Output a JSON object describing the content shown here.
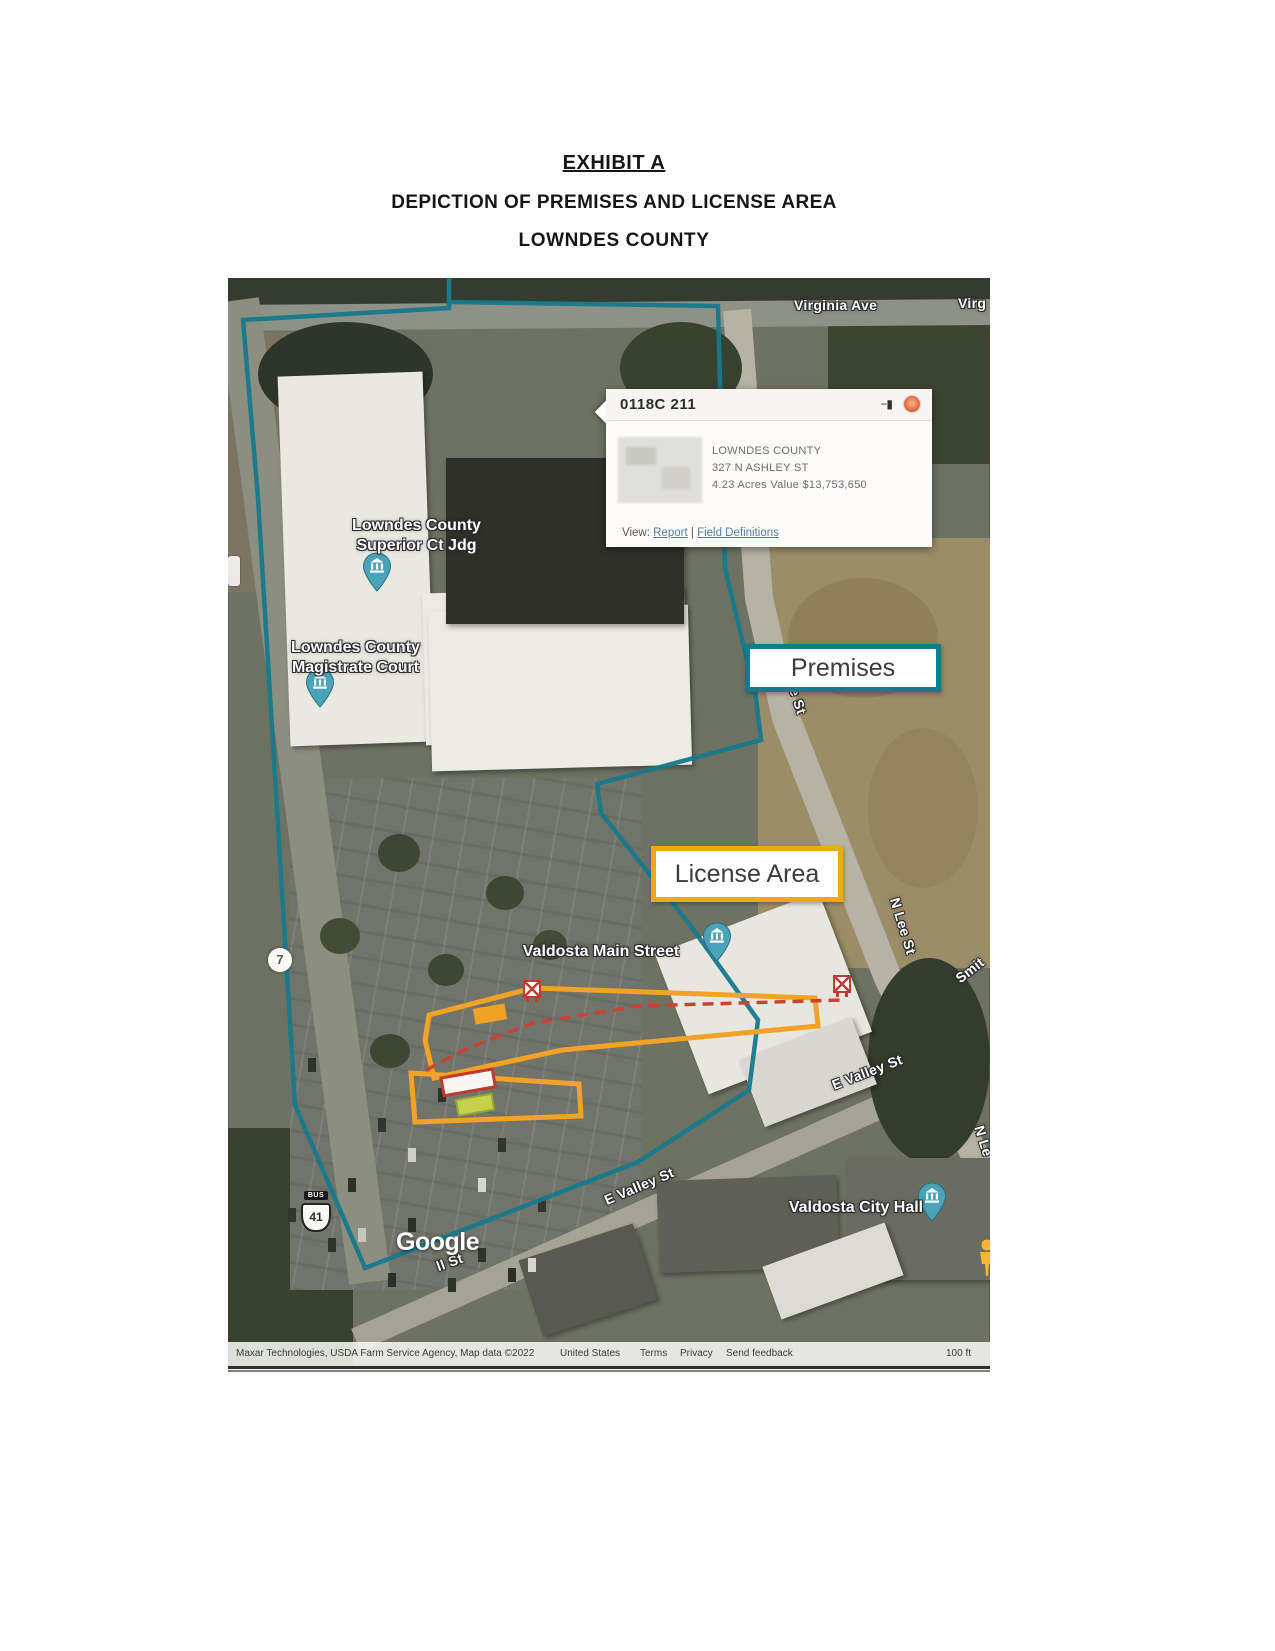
{
  "document": {
    "heading": "EXHIBIT A",
    "subheading": "DEPICTION OF PREMISES AND LICENSE AREA",
    "subheading2": "LOWNDES COUNTY"
  },
  "annotation_boxes": {
    "premises": "Premises",
    "license_area": "License Area"
  },
  "parcel_popup": {
    "parcel_id": "0118C 211",
    "owner": "LOWNDES COUNTY",
    "address": "327 N ASHLEY ST",
    "acres_value": "4.23 Acres  Value $13,753,650",
    "view_label": "View:",
    "report_link": "Report",
    "link_divider": "|",
    "field_definitions_link": "Field Definitions"
  },
  "map": {
    "poi": {
      "superior_court_line1": "Lowndes County",
      "superior_court_line2": "Superior Ct Jdg",
      "magistrate_line1": "Lowndes County",
      "magistrate_line2": "Magistrate Court",
      "valdosta_main_street": "Valdosta Main Street",
      "valdosta_city_hall": "Valdosta City Hall"
    },
    "streets": {
      "virginia_ave": "Virginia Ave",
      "virginia_ave_partial": "Virg",
      "n_lee_st_upper": "N Lee St",
      "n_lee_st_lower": "N Lee St",
      "n_lee_st_partial": "N Le",
      "smith_st_partial": "Smit",
      "e_valley_st_east": "E Valley St",
      "e_valley_st_west": "E Valley St",
      "st_partial": "ll St"
    },
    "shields": {
      "route_7": "7",
      "bus_banner": "BUS",
      "us_41": "41"
    },
    "google_logo": "Google",
    "attribution": {
      "credits": "Maxar Technologies, USDA Farm Service Agency, Map data ©2022",
      "region": "United States",
      "terms": "Terms",
      "privacy": "Privacy",
      "feedback": "Send feedback",
      "scale": "100 ft"
    }
  },
  "colors": {
    "premises_border": "#17798c",
    "license_border": "#f2a71b",
    "route_dashed": "#cd4134",
    "pin_fill": "#4aa3b8",
    "close_button": "#df6b3b"
  }
}
